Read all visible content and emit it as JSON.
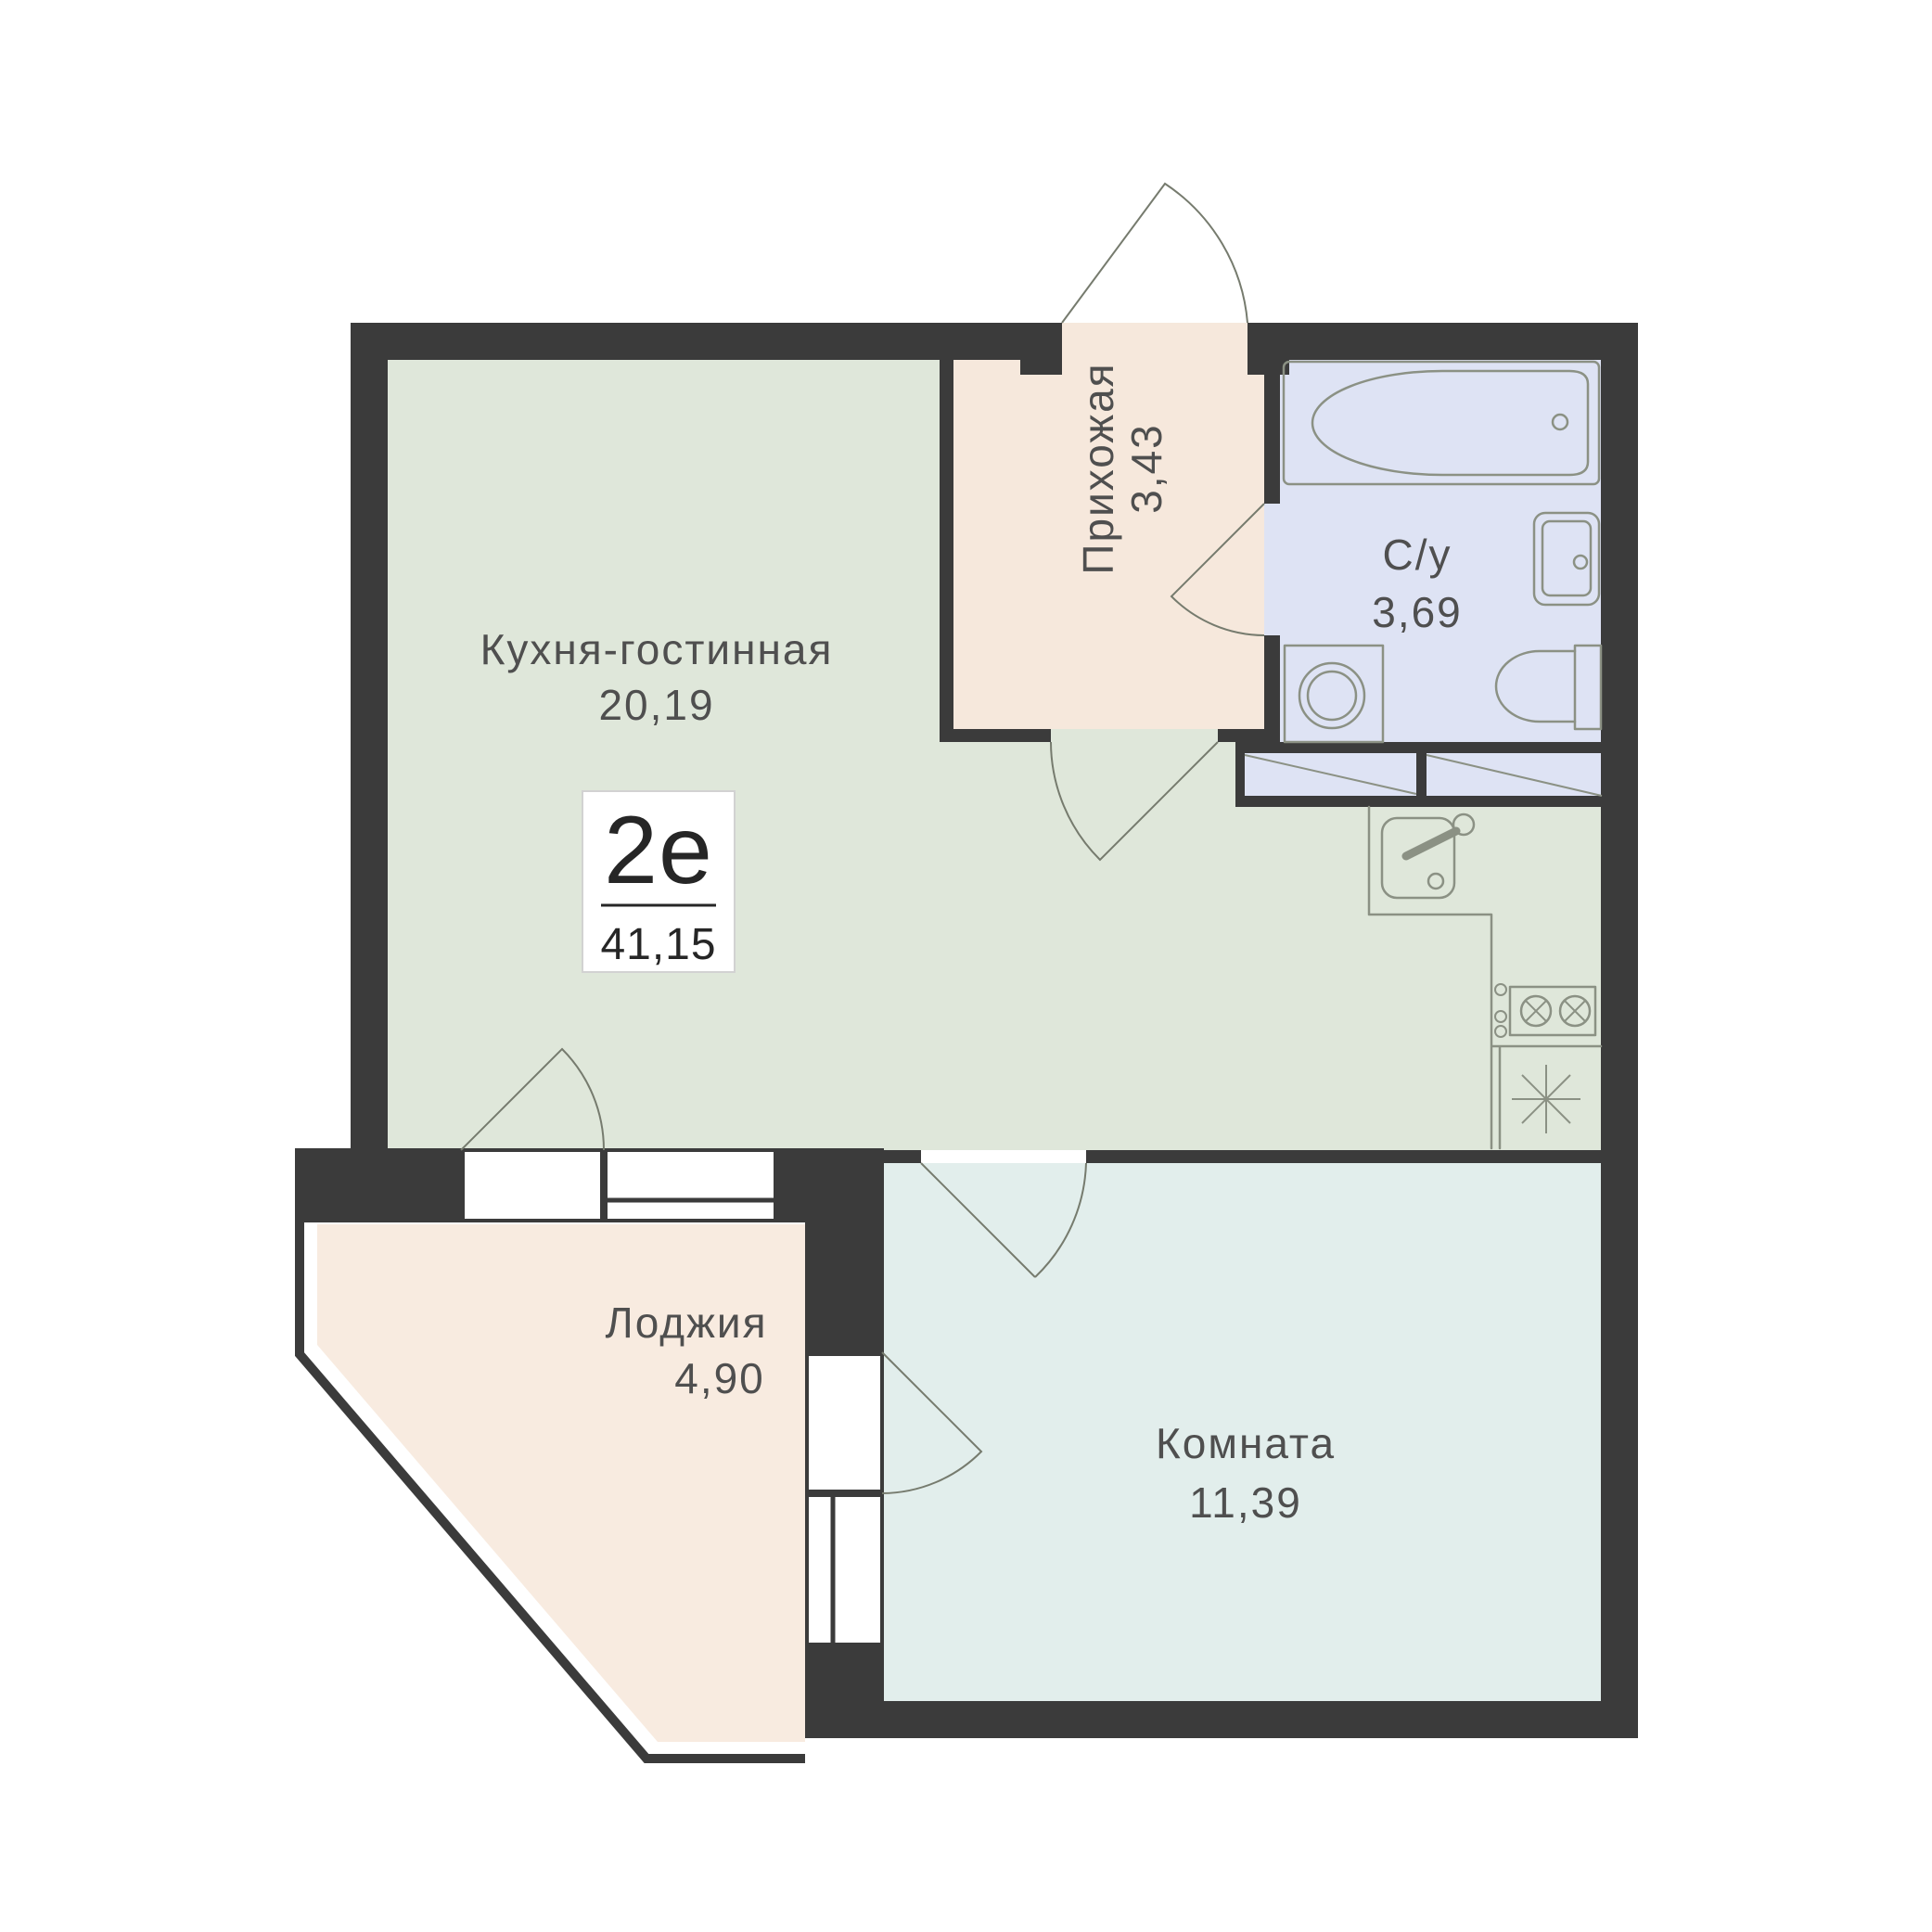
{
  "plan_badge": {
    "unit_type": "2е",
    "total_area": "41,15"
  },
  "rooms": [
    {
      "id": "kitchen-living-room",
      "label": "Кухня-гостинная",
      "area": "20,19",
      "fill": "#dfe7da"
    },
    {
      "id": "hallway",
      "label": "Прихожая",
      "area": "3,43",
      "fill": "#f6e8dc"
    },
    {
      "id": "bathroom",
      "label": "С/у",
      "area": "3,69",
      "fill": "#dee3f4"
    },
    {
      "id": "loggia",
      "label": "Лоджия",
      "area": "4,90",
      "fill": "#f8ebe0"
    },
    {
      "id": "room",
      "label": "Комната",
      "area": "11,39",
      "fill": "#e2eeec"
    }
  ],
  "colors": {
    "wall": "#3b3b3b",
    "fixture_stroke": "#8b9184",
    "door_arc": "#767b6e",
    "label_text": "#4f4f4f",
    "badge_border": "#d2d2d2",
    "background": "#ffffff"
  },
  "fixtures": [
    "bathtub",
    "bathroom-sink",
    "toilet",
    "washing-machine",
    "kitchen-sink",
    "kitchen-counter",
    "stove-2-burner",
    "fridge-vent-asterisk",
    "wardrobe-hatched",
    "entrance-door-arc",
    "interior-door-arcs",
    "balcony-doors",
    "windows"
  ]
}
